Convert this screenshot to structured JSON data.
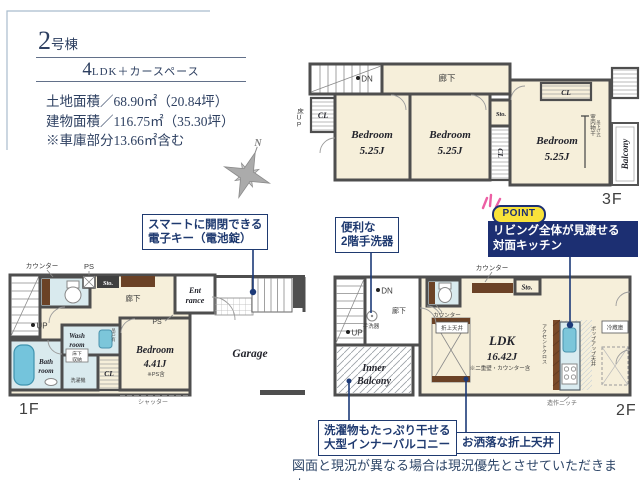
{
  "header": {
    "num": "2",
    "num_suffix": "号棟",
    "plan_num": "4",
    "plan_suffix": "LDK＋カースペース",
    "land": "土地面積／68.90㎡（20.84坪）",
    "building": "建物面積／116.75㎡（35.30坪）",
    "note": "※車庫部分13.66㎡含む"
  },
  "compass": {
    "north": "N"
  },
  "f3": {
    "floor": "3F",
    "dn": "DN",
    "hallway": "廊下",
    "floor_up": "床UP",
    "cl_left": "CL",
    "sto": "Sto.",
    "cl_mid": "CL",
    "cl_top": "CL",
    "bed1": "Bedroom",
    "bed1_size": "5.25J",
    "bed2": "Bedroom",
    "bed2_size": "5.25J",
    "bed3": "Bedroom",
    "bed3_size": "5.25J",
    "drying": "室内物干",
    "drying_type": "吊下げ式",
    "balcony": "Balcony"
  },
  "f1": {
    "floor": "1F",
    "counter": "カウンター",
    "ps_top": "PS",
    "sto": "Sto.",
    "hallway": "廊下",
    "ent1": "Ent",
    "ent2": "rance",
    "up": "UP",
    "wash1": "Wash",
    "wash2": "room",
    "hang": "吊戸有",
    "uf1": "床下",
    "uf2": "収納",
    "washer": "洗濯機",
    "bath1": "Bath",
    "bath2": "room",
    "cl": "CL",
    "ps_bed": "PS",
    "bed": "Bedroom",
    "bed_size": "4.41J",
    "bed_note": "※PS含",
    "garage": "Garage",
    "shutter": "シャッター"
  },
  "f2": {
    "floor": "2F",
    "dn": "DN",
    "up": "UP",
    "handwash": "手洗器",
    "hallway": "廊下",
    "counter_top": "カウンター",
    "counter_wc": "カウンター",
    "sto": "Sto.",
    "raised": "折上天井",
    "ldk": "LDK",
    "ldk_size": "16.42J",
    "ldk_note": "※二重壁・カウンター含",
    "accent": "アクセントクロス",
    "popup": "ポップアップ天井",
    "fridge": "冷蔵庫",
    "ib1": "Inner",
    "ib2": "Balcony",
    "niche": "造作ニッチ"
  },
  "callouts": {
    "c1a": "スマートに開閉できる",
    "c1b": "電子キー（電池錠）",
    "c2a": "便利な",
    "c2b": "2階手洗器",
    "point_badge": "POINT",
    "pa": "リビング全体が見渡せる",
    "pb": "対面キッチン",
    "c3a": "洗濯物もたっぷり干せる",
    "c3b": "大型インナーバルコニー",
    "c4": "お洒落な折上天井"
  },
  "footer": {
    "disclaimer": "図面と現況が異なる場合は現況優先とさせていただきます。"
  }
}
